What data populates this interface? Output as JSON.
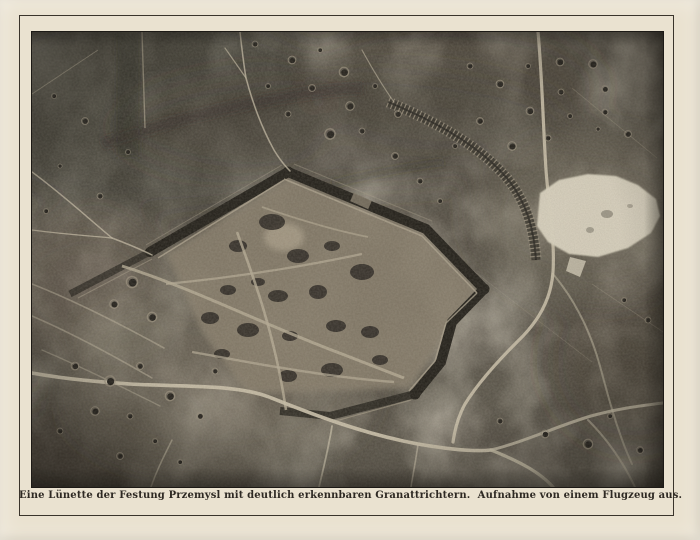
{
  "document": {
    "kind": "printed halftone aerial photograph page",
    "caption": "Eine Lünette der Festung Przemysl mit deutlich erkennbaren Granattrichtern.  Aufnahme von einem Flugzeug aus."
  },
  "photo": {
    "subject": "aerial view of a lunette of fortress Przemysl pocked with shell craters, photographed from an airplane",
    "features": [
      "fortress-rampart-ditch",
      "shell-craters",
      "roads-and-tracks",
      "zigzag-trench",
      "snow-patch"
    ]
  },
  "colors": {
    "paper": "#eae2d0",
    "frame_line": "#3a342b",
    "photo_border": "#1d1a16",
    "photo_base": "#565046",
    "photo_dark": "#221f19",
    "photo_light": "#a89e89",
    "road": "#c6bda6",
    "snow_patch": "#d8d1be",
    "caption_ink": "#2e2923"
  }
}
